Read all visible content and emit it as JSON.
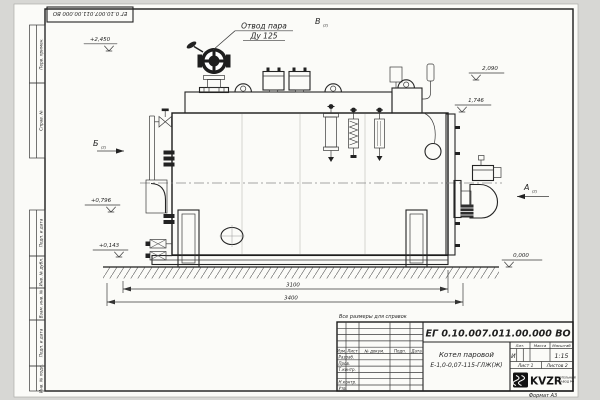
{
  "sheet": {
    "stamp_rotated": "ЕГ 0.10.007.011.00.000  ВО",
    "format_note": "Формат А3",
    "margin_labels": [
      "Перв. примен.",
      "Справ. №",
      "Подп. и дата",
      "Инв. № дубл.",
      "Взам. инв. №",
      "Подп. и дата",
      "Инв. № подл."
    ]
  },
  "drawing": {
    "note": "Все размеры для справок",
    "callout": {
      "line1": "Отвод пара",
      "line2": "Ду 125"
    },
    "views": {
      "a": "А",
      "b": "Б",
      "v": "В",
      "ref": "(2)"
    },
    "elevations": {
      "top": "+2,450",
      "h2090": "2,090",
      "h1746": "1,746",
      "h0796": "+0,796",
      "h0143": "+0,143",
      "zero": "0,000"
    },
    "dimensions": {
      "length_inner": "3100",
      "length_overall": "3400"
    }
  },
  "title_block": {
    "doc_number": "ЕГ 0.10.007.011.00.000  ВО",
    "product_line1": "Котел паровой",
    "product_line2": "Е-1,0-0,07-115-ГЛЖ(Ж)",
    "col_izm": "Изм.",
    "col_list": "Лист",
    "col_doc": "№ докум.",
    "col_podp": "Подп.",
    "col_data": "Дата",
    "row_razrab": "Разраб.",
    "row_prov": "Пров.",
    "row_tkontr": "Т.контр.",
    "row_nkontr": "Н.контр.",
    "row_utv": "Утв.",
    "lit_header": "Лит.",
    "mass_header": "Масса",
    "scale_header": "Масштаб",
    "lit_value": "И",
    "scale_value": "1:15",
    "sheet_label": "Лист 1",
    "sheets_label": "Листов 2",
    "logo_text": "KVZR",
    "logo_sub1": "КОТЕЛЬНЫЙ",
    "logo_sub2": "ЗАВОД РФ"
  }
}
